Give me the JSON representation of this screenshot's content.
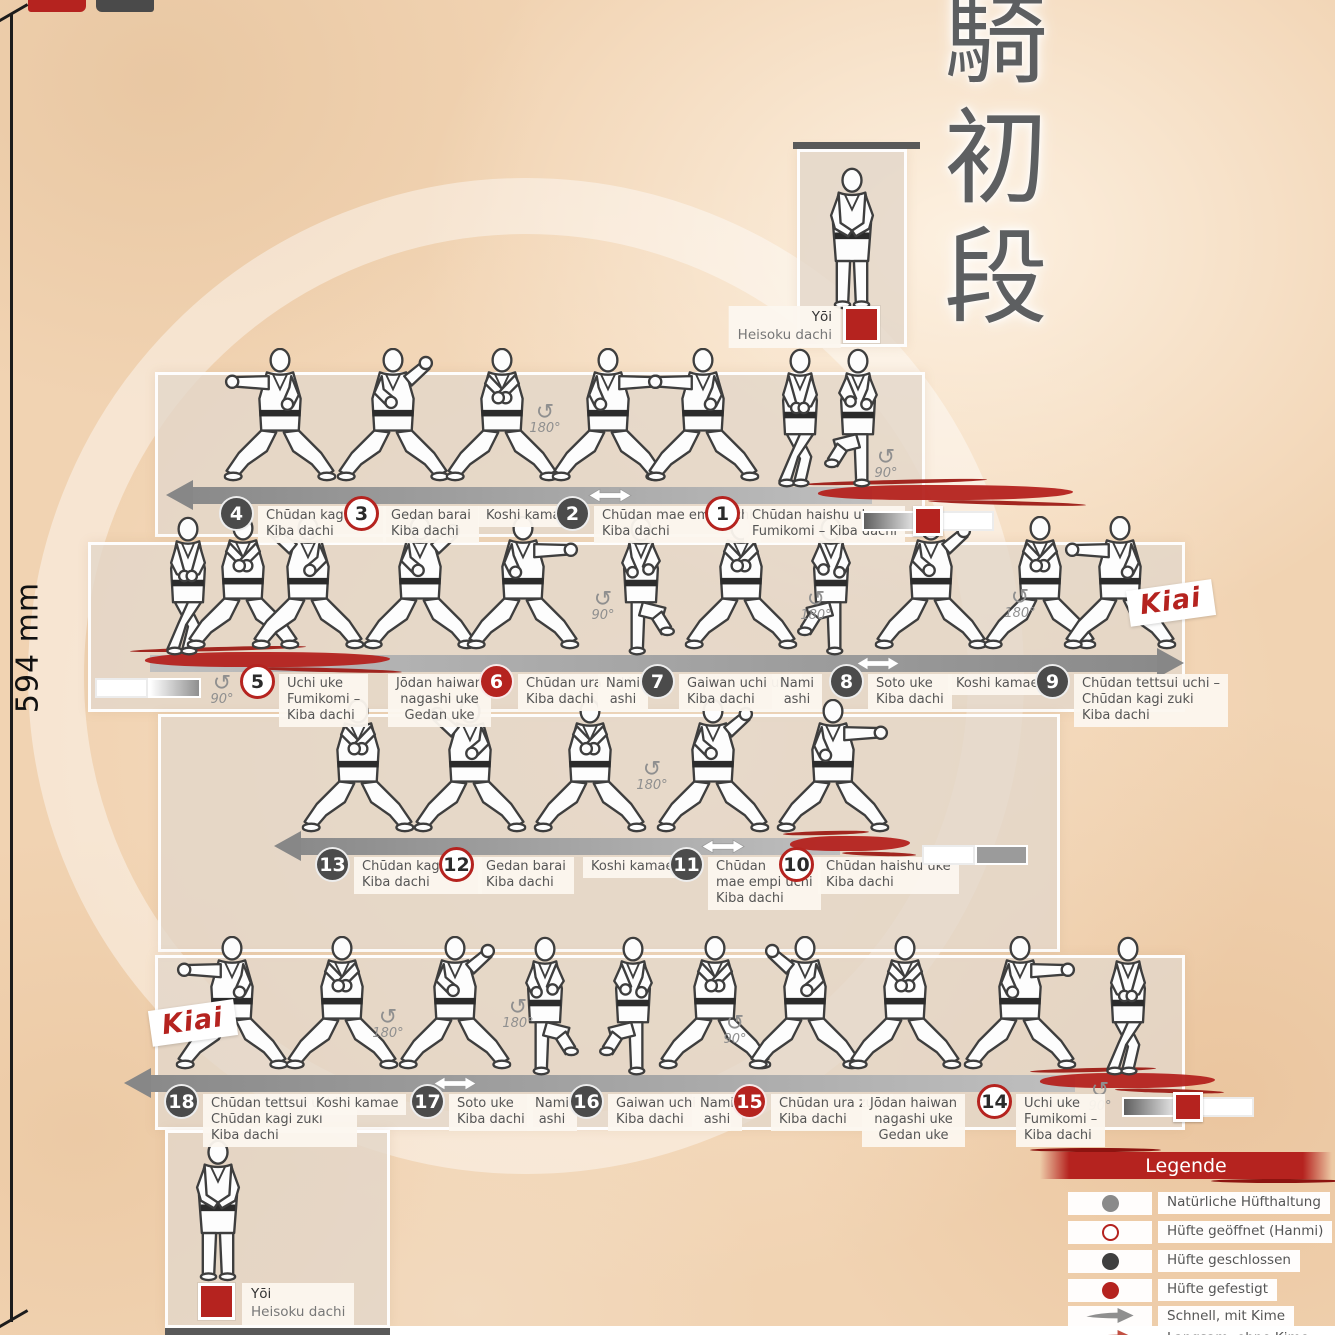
{
  "poster": {
    "kanji": [
      "騎",
      "初",
      "段"
    ],
    "size_label": "594 mm",
    "kiai": "Kiai"
  },
  "colors": {
    "red": "#b5231f",
    "dark_circle": "#4b4b4b",
    "arrow_gray": "#9a9a9a",
    "paper": "#f1d3b2",
    "panel": "#e3d7c9",
    "label_bg": "#fcf7ef",
    "text": "#555555",
    "kanji_gray": "#5d5f61"
  },
  "start": {
    "label": "Yōi",
    "sublabel": "Heisoku dachi",
    "topbar": {
      "left": 793,
      "top": 142,
      "width": 127
    },
    "panel": {
      "left": 797,
      "top": 149,
      "width": 110,
      "height": 198
    },
    "figure": {
      "x": 852,
      "feet": 318
    },
    "square": {
      "left": 843,
      "top": 306
    },
    "labelpos": {
      "x": 841,
      "y": 306
    },
    "label_anchor": "right"
  },
  "end": {
    "label": "Yōi",
    "sublabel": "Heisoku dachi",
    "panel": {
      "left": 165,
      "top": 1130,
      "width": 225,
      "height": 198
    },
    "botbar": {
      "left": 165,
      "top": 1328,
      "width": 225
    },
    "figure": {
      "x": 218,
      "feet": 1290
    },
    "square": {
      "left": 198,
      "top": 1283
    },
    "labelpos": {
      "x": 242,
      "y": 1283
    },
    "label_anchor": "left"
  },
  "rows": [
    {
      "panel": {
        "left": 155,
        "top": 372,
        "width": 770,
        "height": 165
      },
      "band": {
        "left": 192,
        "top": 487,
        "width": 680,
        "dir": "left"
      },
      "brush": {
        "left": 818,
        "top": 485,
        "width": 255
      },
      "bar": {
        "left": 862,
        "top": 506,
        "segments": [
          "grad-left",
          "red",
          "white"
        ]
      },
      "band_markers": [
        610
      ],
      "rotations": [
        {
          "x": 545,
          "y": 405,
          "deg": "180°"
        },
        {
          "x": 886,
          "y": 450,
          "deg": "90°"
        }
      ],
      "figures": [
        {
          "x": 280,
          "v": "kiba2",
          "flip": true
        },
        {
          "x": 393,
          "v": "kiba3"
        },
        {
          "x": 502,
          "v": "kiba1"
        },
        {
          "x": 608,
          "v": "kiba2"
        },
        {
          "x": 703,
          "v": "kiba2",
          "flip": true
        },
        {
          "x": 800,
          "v": "cross"
        },
        {
          "x": 858,
          "v": "knee",
          "flip": true
        }
      ],
      "steps": [
        {
          "left": 219,
          "num": "4",
          "style": "dark",
          "lines": [
            "Chūdan kagi zuki",
            "Kiba dachi"
          ]
        },
        {
          "left": 344,
          "num": "3",
          "style": "open",
          "lines": [
            "Gedan barai",
            "Kiba dachi"
          ]
        },
        {
          "left": 478,
          "style": "none",
          "lines": [
            "Koshi kamae"
          ]
        },
        {
          "left": 555,
          "num": "2",
          "style": "dark",
          "lines": [
            "Chūdan mae empi uchi",
            "Kiba dachi"
          ]
        },
        {
          "left": 705,
          "num": "1",
          "style": "open",
          "lines": [
            "Chūdan haishu uke",
            "Fumikomi – Kiba dachi"
          ]
        }
      ]
    },
    {
      "panel": {
        "left": 88,
        "top": 542,
        "width": 1097,
        "height": 170
      },
      "band": {
        "left": 150,
        "top": 655,
        "width": 1008,
        "dir": "right"
      },
      "brush": {
        "left": 145,
        "top": 652,
        "width": 245
      },
      "bar": {
        "left": 95,
        "top": 678,
        "segments": [
          "white",
          "grad-right"
        ]
      },
      "kiai": {
        "x": 1128,
        "y": 585
      },
      "band_markers": [
        878
      ],
      "rotations": [
        {
          "x": 222,
          "y": 676,
          "deg": "90°"
        },
        {
          "x": 603,
          "y": 592,
          "deg": "90°"
        },
        {
          "x": 816,
          "y": 592,
          "deg": "180°"
        },
        {
          "x": 1020,
          "y": 590,
          "deg": "180°"
        }
      ],
      "figures": [
        {
          "x": 188,
          "v": "cross"
        },
        {
          "x": 243,
          "v": "kiba1"
        },
        {
          "x": 308,
          "v": "kiba3",
          "flip": true
        },
        {
          "x": 420,
          "v": "kiba3"
        },
        {
          "x": 523,
          "v": "kiba2"
        },
        {
          "x": 641,
          "v": "knee"
        },
        {
          "x": 741,
          "v": "kiba1"
        },
        {
          "x": 831,
          "v": "knee",
          "flip": true
        },
        {
          "x": 931,
          "v": "kiba3"
        },
        {
          "x": 1040,
          "v": "kiba1"
        },
        {
          "x": 1120,
          "v": "kiba2",
          "flip": true
        }
      ],
      "steps": [
        {
          "left": 240,
          "num": "5",
          "style": "open",
          "lines": [
            "Uchi uke",
            "Fumikomi –",
            "Kiba dachi"
          ]
        },
        {
          "left": 388,
          "style": "none",
          "center": true,
          "lines": [
            "Jōdan haiwan",
            "nagashi uke",
            "Gedan uke"
          ]
        },
        {
          "left": 479,
          "num": "6",
          "style": "fill",
          "lines": [
            "Chūdan ura zuki",
            "Kiba dachi"
          ]
        },
        {
          "left": 598,
          "style": "none",
          "center": true,
          "lines": [
            "Nami",
            "ashi"
          ]
        },
        {
          "left": 640,
          "num": "7",
          "style": "dark",
          "lines": [
            "Gaiwan uchi uke",
            "Kiba dachi"
          ]
        },
        {
          "left": 772,
          "style": "none",
          "center": true,
          "lines": [
            "Nami",
            "ashi"
          ]
        },
        {
          "left": 829,
          "num": "8",
          "style": "dark",
          "lines": [
            "Soto uke",
            "Kiba dachi"
          ]
        },
        {
          "left": 948,
          "style": "none",
          "lines": [
            "Koshi kamae"
          ]
        },
        {
          "left": 1035,
          "num": "9",
          "style": "dark",
          "lines": [
            "Chūdan tettsui uchi –",
            "Chūdan kagi zuki",
            "Kiba dachi"
          ]
        }
      ]
    },
    {
      "panel": {
        "left": 158,
        "top": 714,
        "width": 902,
        "height": 238
      },
      "band": {
        "left": 300,
        "top": 838,
        "width": 540,
        "dir": "left"
      },
      "brush": {
        "left": 790,
        "top": 836,
        "width": 120
      },
      "bar": {
        "left": 922,
        "top": 845,
        "segments": [
          "white",
          "gray"
        ]
      },
      "band_markers": [
        723
      ],
      "rotations": [
        {
          "x": 652,
          "y": 762,
          "deg": "180°"
        }
      ],
      "figures": [
        {
          "x": 358,
          "v": "kiba1"
        },
        {
          "x": 470,
          "v": "kiba3",
          "flip": true
        },
        {
          "x": 590,
          "v": "kiba1"
        },
        {
          "x": 713,
          "v": "kiba3"
        },
        {
          "x": 833,
          "v": "kiba2"
        }
      ],
      "steps": [
        {
          "left": 315,
          "num": "13",
          "style": "dark",
          "lines": [
            "Chūdan kagi zuki",
            "Kiba dachi"
          ]
        },
        {
          "left": 439,
          "num": "12",
          "style": "open",
          "lines": [
            "Gedan barai",
            "Kiba dachi"
          ]
        },
        {
          "left": 583,
          "style": "none",
          "lines": [
            "Koshi kamae"
          ]
        },
        {
          "left": 669,
          "num": "11",
          "style": "dark",
          "lines": [
            "Chūdan",
            "mae empi uchi",
            "Kiba dachi"
          ]
        },
        {
          "left": 779,
          "num": "10",
          "style": "open",
          "lines": [
            "Chūdan haishu uke",
            "Kiba dachi"
          ]
        }
      ]
    },
    {
      "panel": {
        "left": 155,
        "top": 955,
        "width": 1030,
        "height": 175
      },
      "band": {
        "left": 150,
        "top": 1075,
        "width": 925,
        "dir": "left"
      },
      "brush": {
        "left": 1040,
        "top": 1073,
        "width": 175
      },
      "bar": {
        "left": 1122,
        "top": 1092,
        "segments": [
          "grad-left",
          "red",
          "white"
        ]
      },
      "kiai": {
        "x": 150,
        "y": 1005
      },
      "band_markers": [
        455
      ],
      "rotations": [
        {
          "x": 388,
          "y": 1010,
          "deg": "180°"
        },
        {
          "x": 518,
          "y": 1000,
          "deg": "180°"
        },
        {
          "x": 735,
          "y": 1016,
          "deg": "90°"
        },
        {
          "x": 1100,
          "y": 1083,
          "deg": "90°"
        }
      ],
      "figures": [
        {
          "x": 232,
          "v": "kiba2",
          "flip": true
        },
        {
          "x": 342,
          "v": "kiba1"
        },
        {
          "x": 455,
          "v": "kiba3"
        },
        {
          "x": 545,
          "v": "knee"
        },
        {
          "x": 633,
          "v": "knee",
          "flip": true
        },
        {
          "x": 715,
          "v": "kiba1"
        },
        {
          "x": 805,
          "v": "kiba3",
          "flip": true
        },
        {
          "x": 905,
          "v": "kiba1"
        },
        {
          "x": 1020,
          "v": "kiba2"
        },
        {
          "x": 1128,
          "v": "cross"
        }
      ],
      "steps": [
        {
          "left": 164,
          "num": "18",
          "style": "dark",
          "lines": [
            "Chūdan tettsui uchi –",
            "Chūdan kagi zuki",
            "Kiba dachi"
          ]
        },
        {
          "left": 308,
          "style": "none",
          "lines": [
            "Koshi kamae"
          ]
        },
        {
          "left": 410,
          "num": "17",
          "style": "dark",
          "lines": [
            "Soto uke",
            "Kiba dachi"
          ]
        },
        {
          "left": 527,
          "style": "none",
          "center": true,
          "lines": [
            "Nami",
            "ashi"
          ]
        },
        {
          "left": 569,
          "num": "16",
          "style": "dark",
          "lines": [
            "Gaiwan uchi uke",
            "Kiba dachi"
          ]
        },
        {
          "left": 692,
          "style": "none",
          "center": true,
          "lines": [
            "Nami",
            "ashi"
          ]
        },
        {
          "left": 732,
          "num": "15",
          "style": "fill",
          "lines": [
            "Chūdan ura zuki",
            "Kiba dachi"
          ]
        },
        {
          "left": 862,
          "style": "none",
          "center": true,
          "lines": [
            "Jōdan haiwan",
            "nagashi uke",
            "Gedan uke"
          ]
        },
        {
          "left": 977,
          "num": "14",
          "style": "open",
          "lines": [
            "Uchi uke",
            "Fumikomi –",
            "Kiba dachi"
          ]
        }
      ]
    }
  ],
  "legend": {
    "title": "Legende",
    "items": [
      {
        "sym": "circle-gray",
        "label": "Natürliche Hüfthaltung"
      },
      {
        "sym": "circle-open",
        "label": "Hüfte geöffnet (Hanmi)"
      },
      {
        "sym": "circle-dark",
        "label": "Hüfte geschlossen"
      },
      {
        "sym": "circle-red",
        "label": "Hüfte gefestigt"
      },
      {
        "sym": "arrow-gray",
        "label": "Schnell, mit Kime"
      },
      {
        "sym": "arrow-red",
        "label": "Langsam, ohne Kime"
      }
    ]
  }
}
